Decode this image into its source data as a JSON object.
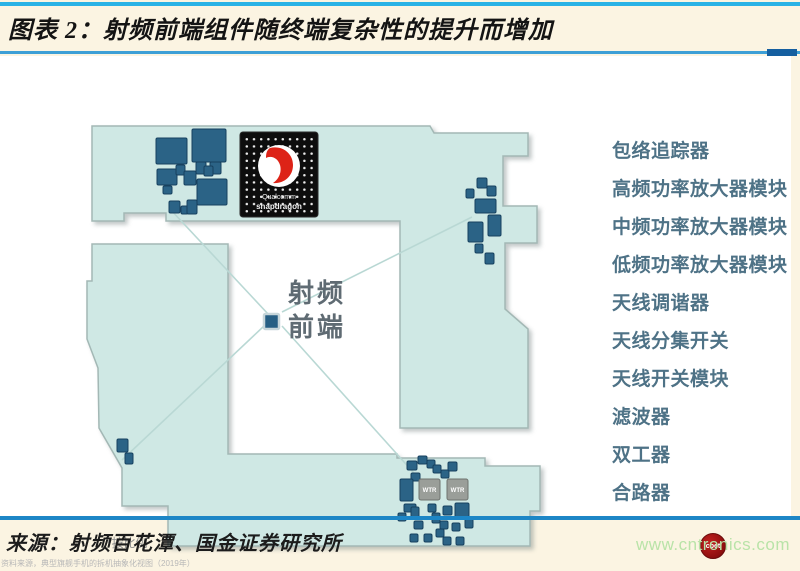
{
  "title": "图表 2：射频前端组件随终端复杂性的提升而增加",
  "diagram": {
    "center_label": {
      "line1": "射频",
      "line2": "前端"
    },
    "chip": {
      "line1": "Qualcomm",
      "line2": "snapdragon"
    },
    "wtr_label": "WTR",
    "scale_note": "*按比例",
    "caption": "资料来源，典型旗舰手机的拆机抽象化视图（2019年）"
  },
  "component_list": [
    "包络追踪器",
    "高频功率放大器模块",
    "中频功率放大器模块",
    "低频功率放大器模块",
    "天线调谐器",
    "天线分集开关",
    "天线开关模块",
    "滤波器",
    "双工器",
    "合路器"
  ],
  "badge_text": "cbet",
  "footer": {
    "source": "来源：射频百花潭、国金证券研究所",
    "website": "www.cntronics.com"
  },
  "colors": {
    "accent_blue": "#1d86c6",
    "pcb_fill": "#cfe8e4",
    "component_fill": "#2b6386",
    "list_text": "#4e7286",
    "website_green": "#b9e3a8",
    "badge_red": "#8e0f0f"
  }
}
